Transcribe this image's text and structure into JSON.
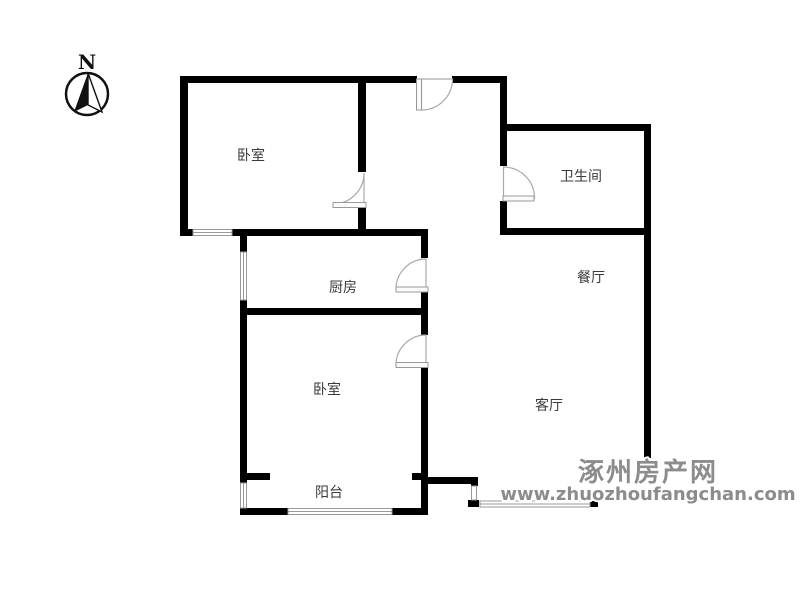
{
  "compass": {
    "label": "N"
  },
  "rooms": [
    {
      "id": "bedroom-top",
      "label": "卧室"
    },
    {
      "id": "bathroom",
      "label": "卫生间"
    },
    {
      "id": "kitchen",
      "label": "厨房"
    },
    {
      "id": "dining",
      "label": "餐厅"
    },
    {
      "id": "bedroom-bottom",
      "label": "卧室"
    },
    {
      "id": "living",
      "label": "客厅"
    },
    {
      "id": "balcony",
      "label": "阳台"
    }
  ],
  "watermark": {
    "site_name": "涿州房产网",
    "site_url": "www.zhuozhoufangchan.com"
  },
  "colors": {
    "wall": "#000000",
    "label": "#3a3a3a",
    "window_line": "#999999",
    "door_stroke": "#aaaaaa",
    "leaf_fill": "#fafafa",
    "watermark": "#8c8c8c",
    "compass": "#111111"
  }
}
